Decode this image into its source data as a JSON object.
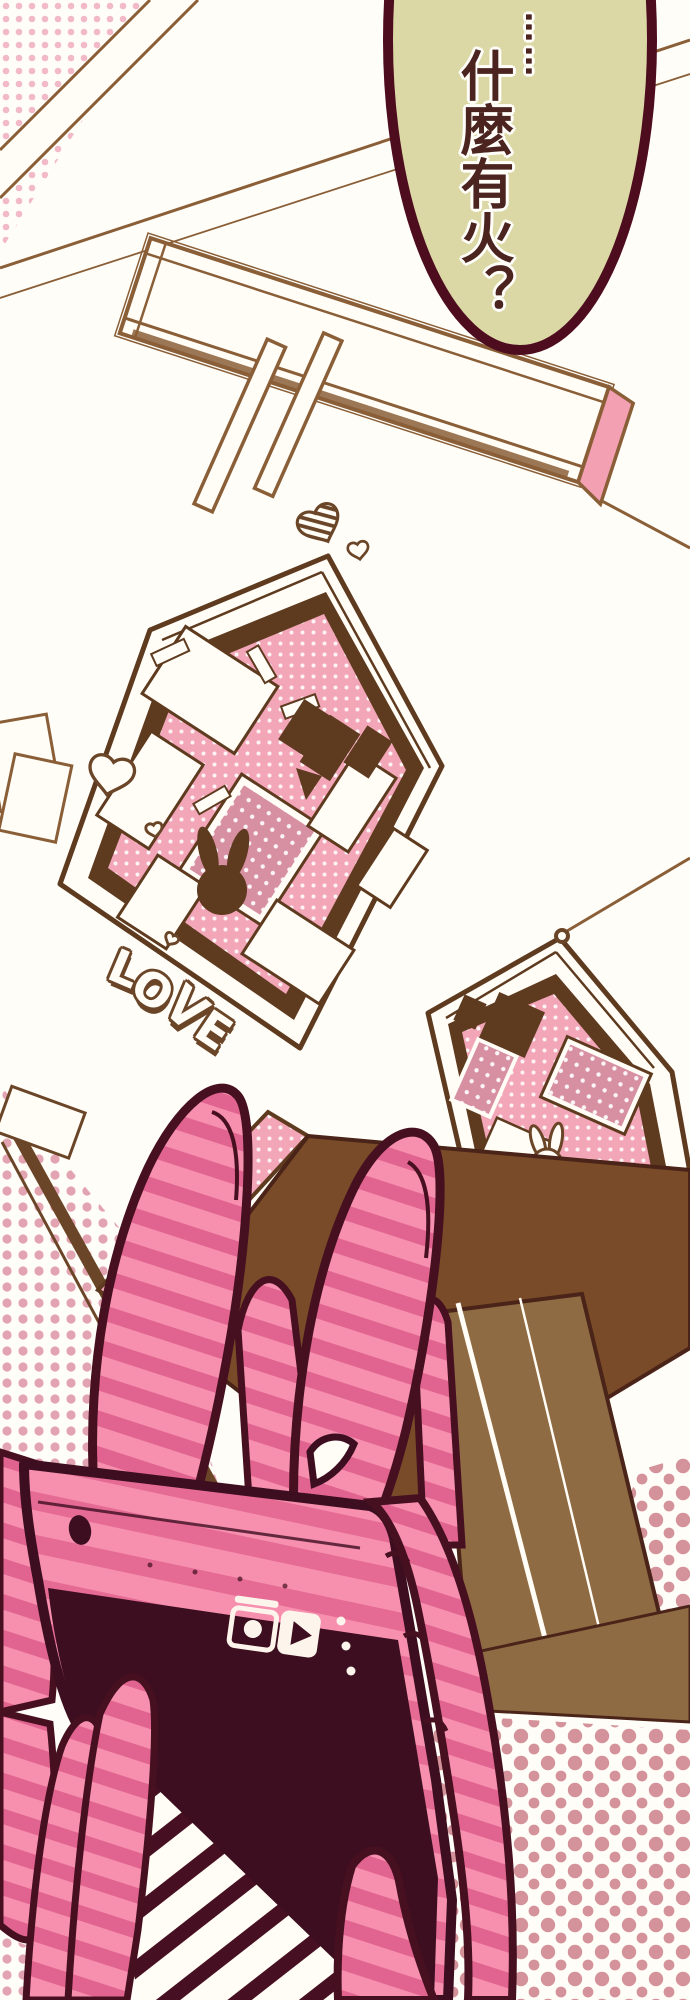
{
  "panel": {
    "speech_bubble": {
      "ellipsis": "……",
      "text": "什麼有火？",
      "fill": "#dbd8a6",
      "outline": "#4e0c1f",
      "text_color": "#4b2420"
    },
    "pinboard": {
      "caption": "LOVE"
    },
    "phone": {
      "camera_icon": "camera-icon",
      "play_icon": "play-icon",
      "menu_dot_count": 3,
      "screen_color": "#3c0e1f",
      "body_stripe_light": "#f78fae",
      "body_stripe_dark": "#e56b95"
    },
    "colors": {
      "outline_maroon": "#471021",
      "sketch_brown": "#8a5f38",
      "frame_brown": "#5e3a1f",
      "board_pink": "#f2a6b8",
      "photo_dark_pink": "#d78fa2",
      "halftone_pink": "#f2bac8",
      "halftone_rose": "#d4939a",
      "door_tan": "#8f6b44",
      "table_brown": "#7a4b28",
      "bubble_green": "#dbd8a6",
      "shirt_stripe": "#471022",
      "paper_white": "#fffdf6"
    }
  }
}
